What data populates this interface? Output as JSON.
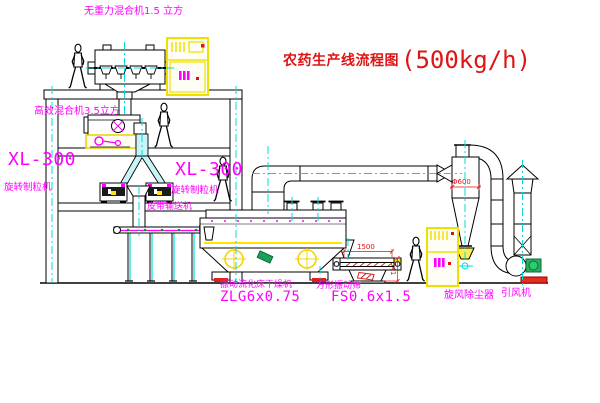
{
  "title": {
    "name": "农药生产线流程图",
    "capacity": "(500kg/h)"
  },
  "equipment_labels": {
    "top_mixer": "无重力混合机1.5 立方",
    "high_efficiency_mixer": "高效混合机3.5立方",
    "granulator_left_model": "XL-300",
    "granulator_left_name": "旋转制粒机",
    "granulator_right_model": "XL-300",
    "granulator_right_name": "旋转制粒机",
    "belt_conveyor": "皮带输送机",
    "fluid_bed_dryer_name": "振动流化床干燥机",
    "fluid_bed_dryer_model": "ZLG6x0.75",
    "vibrating_screen_name": "方形振动筛",
    "vibrating_screen_model": "FS0.6x1.5",
    "cyclone": "旋风除尘器",
    "induced_draft_fan": "引风机"
  },
  "dimensions": {
    "screen_length": "1500",
    "screen_height": "541",
    "cyclone_diameter": "Φ600"
  },
  "colors": {
    "label_magenta": "#ff00ff",
    "title_red": "#dd1515",
    "dimension_red": "#e01010",
    "centerline_cyan": "#00e0e0",
    "cabinet_yellow": "#f0e000",
    "valve_green": "#1fa05a",
    "line_black": "#000000"
  }
}
